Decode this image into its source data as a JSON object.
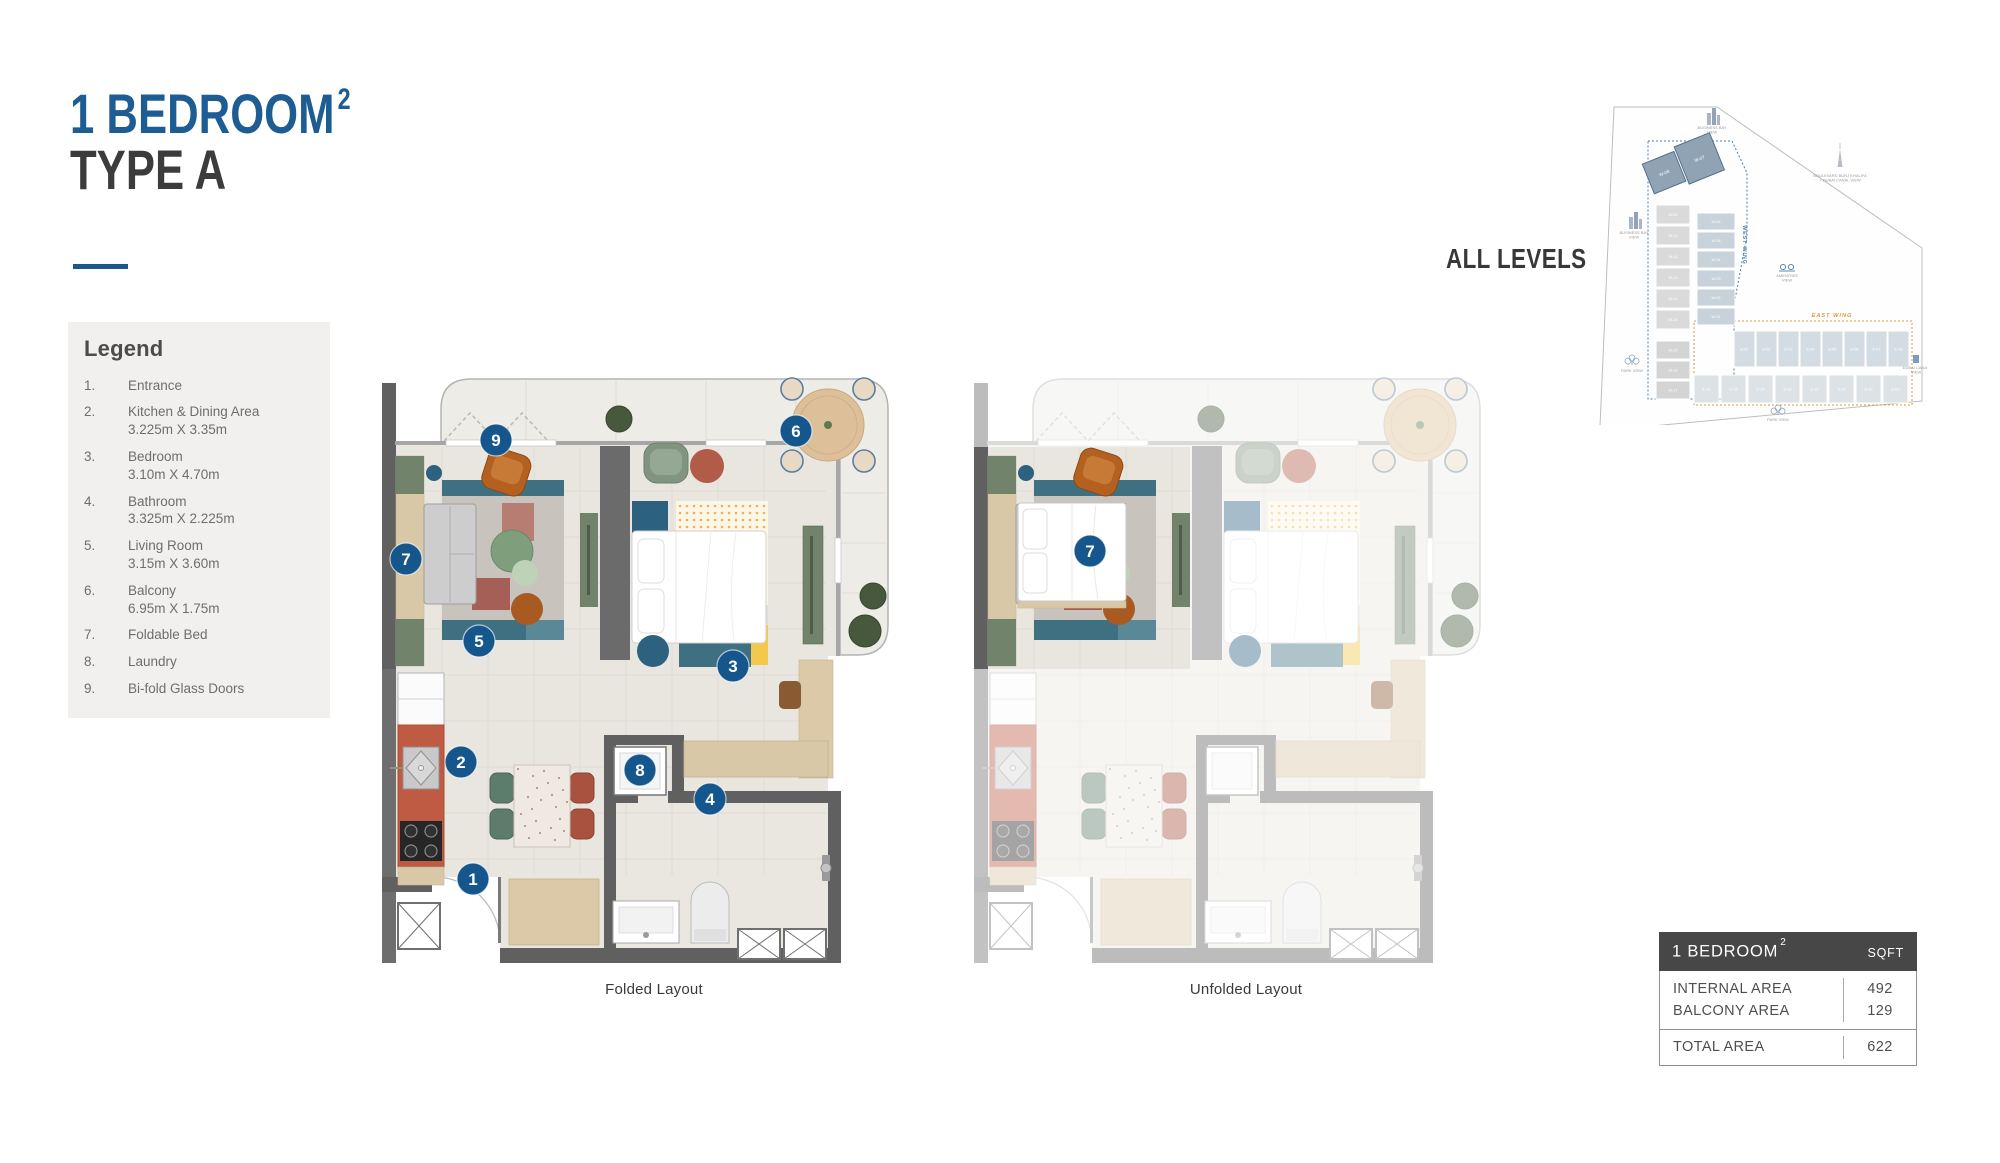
{
  "header": {
    "title_line1": "1 BEDROOM",
    "title_sup": "2",
    "title_line2": "TYPE A"
  },
  "legend": {
    "heading": "Legend",
    "items": [
      {
        "num": "1.",
        "label": "Entrance",
        "dims": ""
      },
      {
        "num": "2.",
        "label": "Kitchen & Dining Area",
        "dims": "3.225m X 3.35m"
      },
      {
        "num": "3.",
        "label": "Bedroom",
        "dims": "3.10m X 4.70m"
      },
      {
        "num": "4.",
        "label": "Bathroom",
        "dims": "3.325m X 2.225m"
      },
      {
        "num": "5.",
        "label": "Living Room",
        "dims": "3.15m X 3.60m"
      },
      {
        "num": "6.",
        "label": "Balcony",
        "dims": "6.95m X 1.75m"
      },
      {
        "num": "7.",
        "label": "Foldable Bed",
        "dims": ""
      },
      {
        "num": "8.",
        "label": "Laundry",
        "dims": ""
      },
      {
        "num": "9.",
        "label": "Bi-fold Glass Doors",
        "dims": ""
      }
    ]
  },
  "plans": {
    "folded": {
      "caption": "Folded Layout",
      "badges": [
        "1",
        "2",
        "3",
        "4",
        "5",
        "6",
        "7",
        "8",
        "9"
      ]
    },
    "unfolded": {
      "caption": "Unfolded Layout",
      "badges": [
        "7"
      ]
    }
  },
  "site_plan": {
    "heading": "ALL LEVELS",
    "west_wing_label": "WEST WING",
    "east_wing_label": "EAST WING",
    "highlight_units": [
      "W-08",
      "W-07"
    ],
    "west_outer_units": [
      "W-09",
      "W-10",
      "W-11",
      "W-12",
      "W-13",
      "W-14"
    ],
    "west_lower_units": [
      "W-15",
      "W-16",
      "W-17"
    ],
    "west_inner_units": [
      "W-06",
      "W-05",
      "W-04",
      "W-03",
      "W-02",
      "W-01"
    ],
    "east_top_units": [
      "E-01",
      "E-02",
      "E-03",
      "E-04",
      "E-05",
      "E-06",
      "E-07",
      "E-08"
    ],
    "east_bottom_units": [
      "E-16",
      "E-15",
      "E-14",
      "E-13",
      "E-12",
      "E-11",
      "E-10",
      "E-09"
    ],
    "view_labels": {
      "business_bay_top": [
        "BUSINESS BAY",
        "VIEW"
      ],
      "business_bay_left": [
        "BUSINESS BAY",
        "VIEW"
      ],
      "boulevard": [
        "BOULEVARD BURJ KHALIFA",
        "+ DUBAI CANAL VIEW"
      ],
      "amenities": [
        "AMENITIES",
        "VIEW"
      ],
      "park_left": [
        "PARK VIEW"
      ],
      "park_bottom": [
        "PARK VIEW"
      ],
      "dubai_canal": [
        "DUBAI CANAL",
        "VIEW"
      ]
    }
  },
  "area_table": {
    "header_left": "1 BEDROOM",
    "header_sup": "2",
    "header_right": "SQFT",
    "rows": [
      {
        "label": "INTERNAL AREA",
        "value": "492"
      },
      {
        "label": "BALCONY AREA",
        "value": "129"
      }
    ],
    "total": {
      "label": "TOTAL AREA",
      "value": "622"
    }
  },
  "colors": {
    "title_blue": "#1d5d93",
    "badge_blue": "#15568c",
    "table_header": "#474747",
    "west_wing_blue": "#4a7fae",
    "east_wing_orange": "#d79b3c",
    "wall_gray": "#606060",
    "floor": "#e9e6e0",
    "balcony_floor": "#edece6",
    "accent_teal": "#3e7082",
    "accent_terracotta": "#bf5b43",
    "accent_yellow": "#f2c84e"
  }
}
